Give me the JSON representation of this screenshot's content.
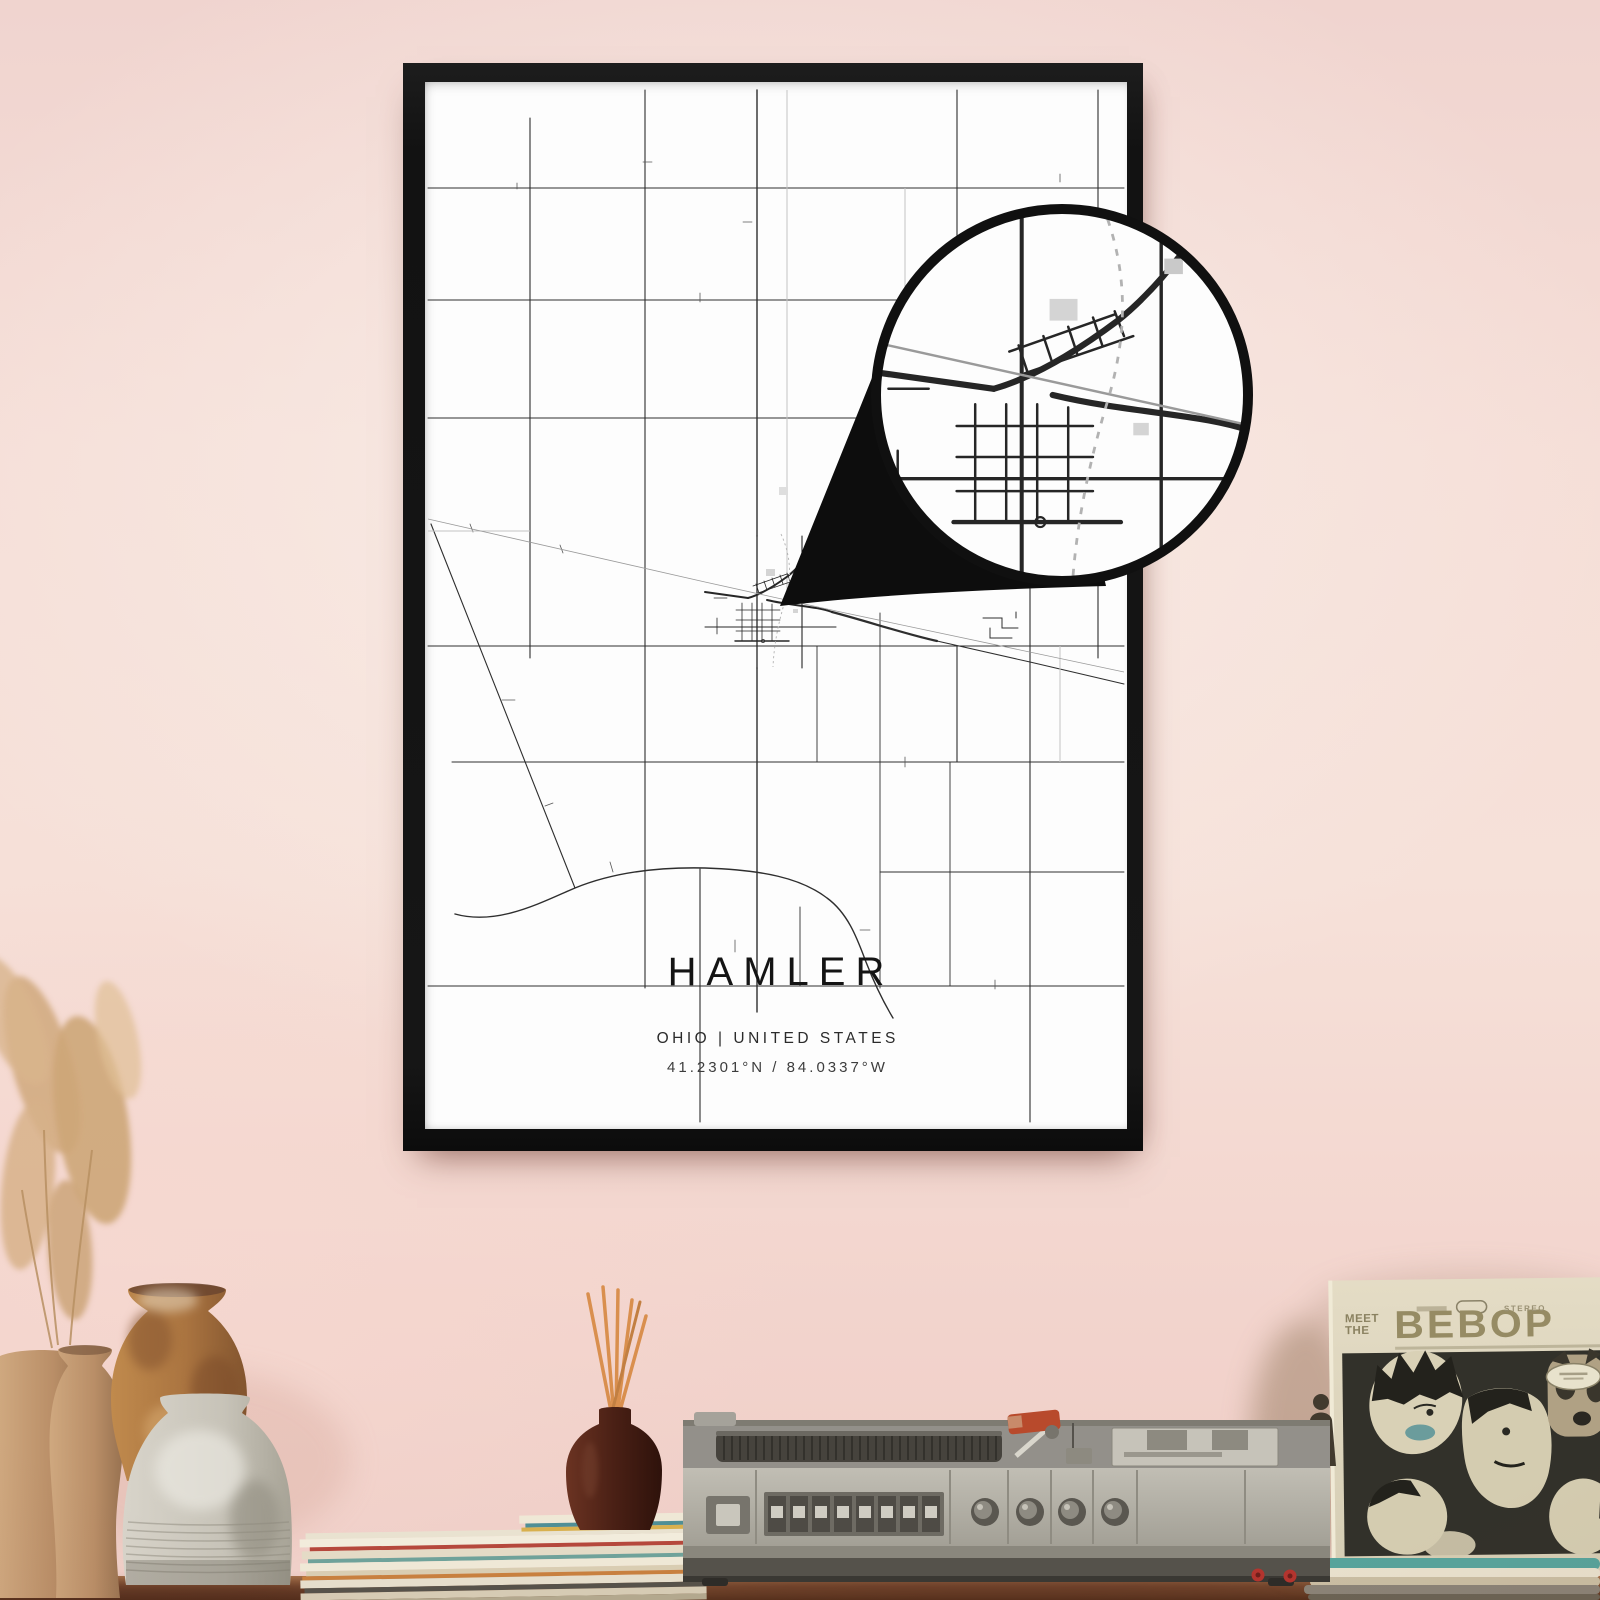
{
  "poster": {
    "title": "HAMLER",
    "subtitle": "OHIO | UNITED STATES",
    "coordinates": "41.2301°N / 84.0337°W"
  },
  "album": {
    "title_top": "MEET",
    "title_mid": "THE",
    "title_main": "BEBOP",
    "stereo_label": "STEREO"
  },
  "colors": {
    "wall_pink": "#f3d8d2",
    "frame_black": "#151515",
    "poster_white": "#fdfdfd",
    "map_line": "#2e2e2e",
    "magnifier_ring": "#101010",
    "album_title": "#968b64",
    "album_photo_bg": "#32312a",
    "accent_red": "#b3342e",
    "record_teal": "#57a39b",
    "table_brown": "#7c4c30",
    "radio_gray": "#b5b2a8",
    "vase_orange": "#b5823f",
    "vase_gray": "#cdc9bf",
    "vase_tan": "#c09878"
  }
}
